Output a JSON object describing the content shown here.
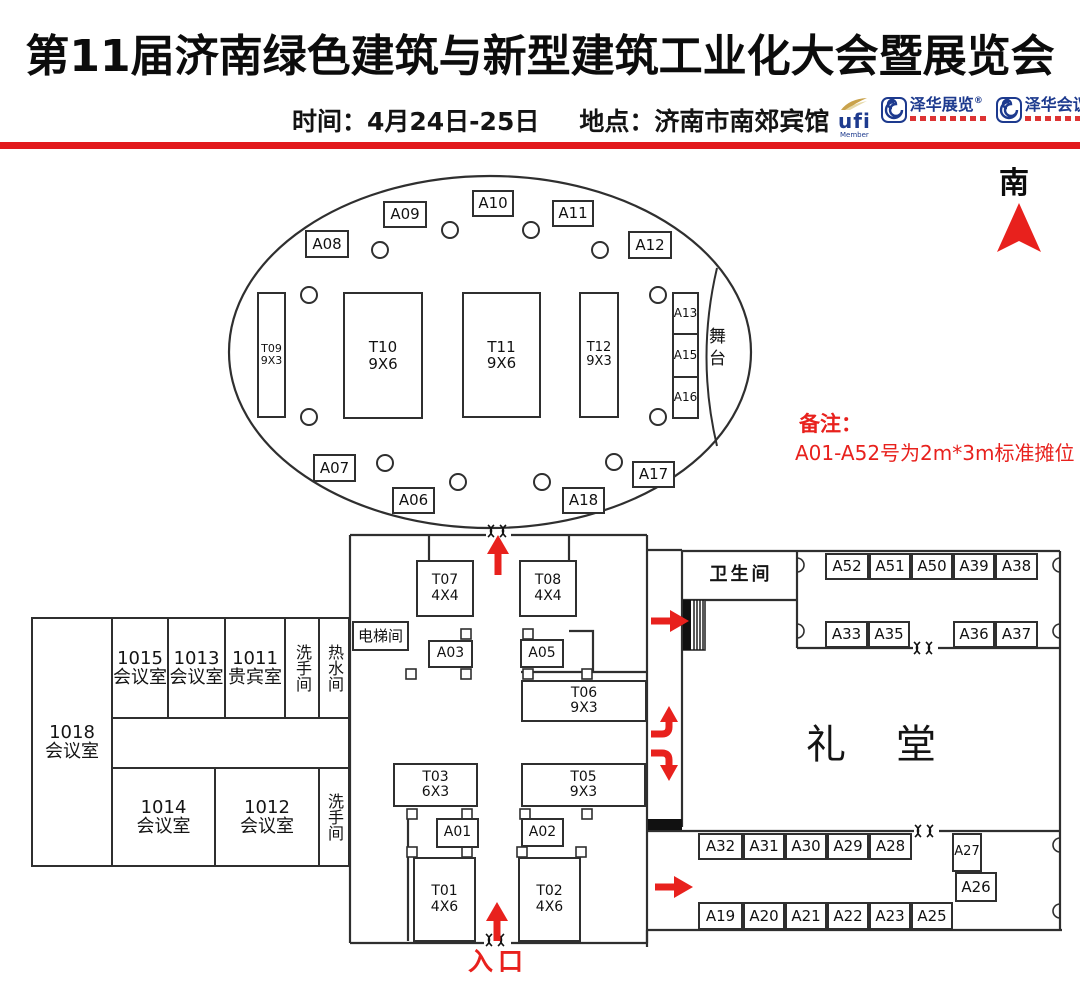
{
  "header": {
    "title": "第11届济南绿色建筑与新型建筑工业化大会暨展览会",
    "time_label": "时间：4月24日-25日",
    "venue_label": "地点：济南市南郊宾馆",
    "logos": {
      "ufi": "ufi",
      "ufi_member": "Member",
      "zehua_exhibition": "泽华展览",
      "zehua_conference": "泽华会议",
      "reg_mark": "®"
    }
  },
  "compass": {
    "label": "南"
  },
  "note": {
    "title": "备注：",
    "text": "A01-A52号为2m*3m标准摊位"
  },
  "entrance": {
    "label": "入口"
  },
  "rooms": {
    "stage": "舞台",
    "elevator": "电梯间",
    "toilet": "卫生间",
    "auditorium": "礼堂",
    "meeting_1018": "1018\n会议室",
    "meeting_1015": "1015\n会议室",
    "meeting_1013": "1013\n会议室",
    "vip_1011": "1011\n贵宾室",
    "washroom_top": "洗手间",
    "hot_water": "热水间",
    "meeting_1014": "1014\n会议室",
    "meeting_1012": "1012\n会议室",
    "washroom_bottom": "洗手间"
  },
  "booths": {
    "A01": "A01",
    "A02": "A02",
    "A03": "A03",
    "A05": "A05",
    "A06": "A06",
    "A07": "A07",
    "A08": "A08",
    "A09": "A09",
    "A10": "A10",
    "A11": "A11",
    "A12": "A12",
    "A13": "A13",
    "A15": "A15",
    "A16": "A16",
    "A17": "A17",
    "A18": "A18",
    "A19": "A19",
    "A20": "A20",
    "A21": "A21",
    "A22": "A22",
    "A23": "A23",
    "A25": "A25",
    "A26": "A26",
    "A27": "A27",
    "A28": "A28",
    "A29": "A29",
    "A30": "A30",
    "A31": "A31",
    "A32": "A32",
    "A33": "A33",
    "A35": "A35",
    "A36": "A36",
    "A37": "A37",
    "A38": "A38",
    "A39": "A39",
    "A50": "A50",
    "A51": "A51",
    "A52": "A52",
    "T01": "T01\n4X6",
    "T02": "T02\n4X6",
    "T03": "T03\n6X3",
    "T05": "T05\n9X3",
    "T06": "T06\n9X3",
    "T07": "T07\n4X4",
    "T08": "T08\n4X4",
    "T09": "T09\n9X3",
    "T10": "T10\n9X6",
    "T11": "T11\n9X6",
    "T12": "T12\n9X3"
  },
  "colors": {
    "accent_red": "#e8211d",
    "wall": "#2f2f2f",
    "logo_blue": "#1d3a8e",
    "logo_gold": "#c9a24b"
  }
}
